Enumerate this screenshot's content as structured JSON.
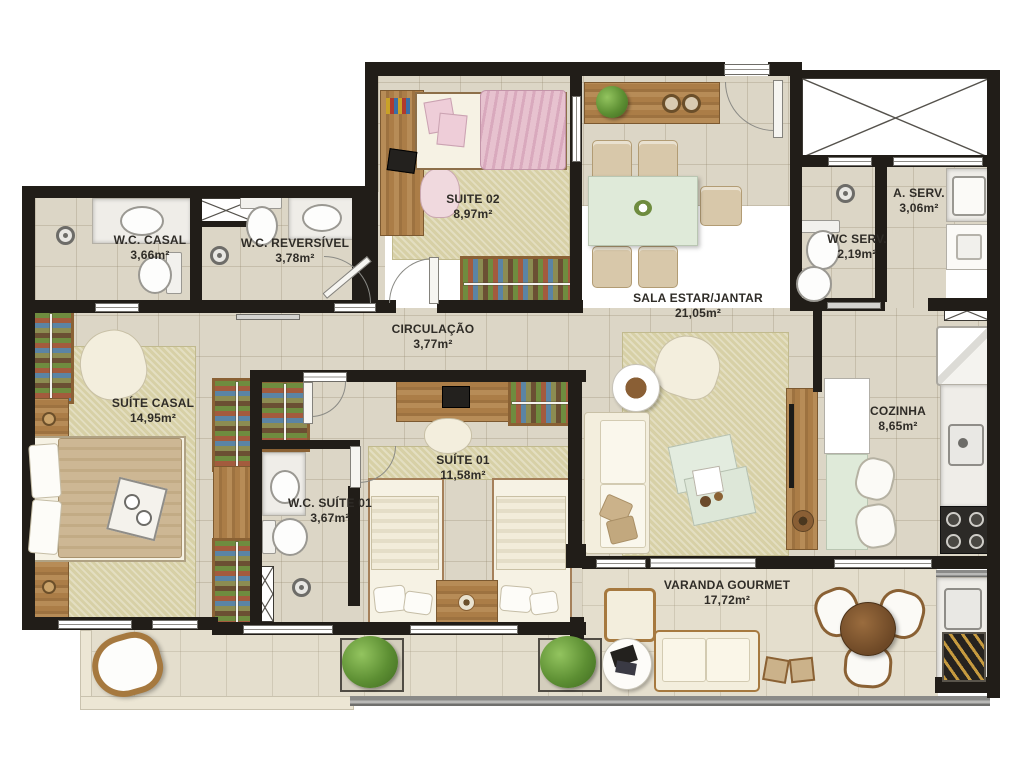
{
  "plan_title": "apartment-floor-plan",
  "rooms": [
    {
      "id": "wc-casal",
      "name": "W.C. CASAL",
      "area": "3,66m²"
    },
    {
      "id": "wc-reversivel",
      "name": "W.C. REVERSÍVEL",
      "area": "3,78m²"
    },
    {
      "id": "suite-02",
      "name": "SUITE 02",
      "area": "8,97m²"
    },
    {
      "id": "sala",
      "name": "SALA ESTAR/JANTAR",
      "area": "21,05m²"
    },
    {
      "id": "a-serv",
      "name": "A. SERV.",
      "area": "3,06m²"
    },
    {
      "id": "wc-serv",
      "name": "WC SERV.",
      "area": "2,19m²"
    },
    {
      "id": "circulacao",
      "name": "CIRCULAÇÃO",
      "area": "3,77m²"
    },
    {
      "id": "suite-casal",
      "name": "SUÍTE CASAL",
      "area": "14,95m²"
    },
    {
      "id": "wc-suite-01",
      "name": "W.C. SUÍTE 01",
      "area": "3,67m²"
    },
    {
      "id": "suite-01",
      "name": "SUÍTE 01",
      "area": "11,58m²"
    },
    {
      "id": "cozinha",
      "name": "COZINHA",
      "area": "8,65m²"
    },
    {
      "id": "varanda",
      "name": "VARANDA GOURMET",
      "area": "17,72m²"
    }
  ],
  "colors": {
    "wall": "#211d18",
    "floor_tile": "#dcd6c6",
    "balcony_tile": "#e4decd",
    "rug": "#d7d0a6",
    "wood": "#ab7d47",
    "marble": "#efede8",
    "pink_bedding": "#e7c2cf",
    "green_table": "#dfead9",
    "label_text": "#2f2c27"
  }
}
